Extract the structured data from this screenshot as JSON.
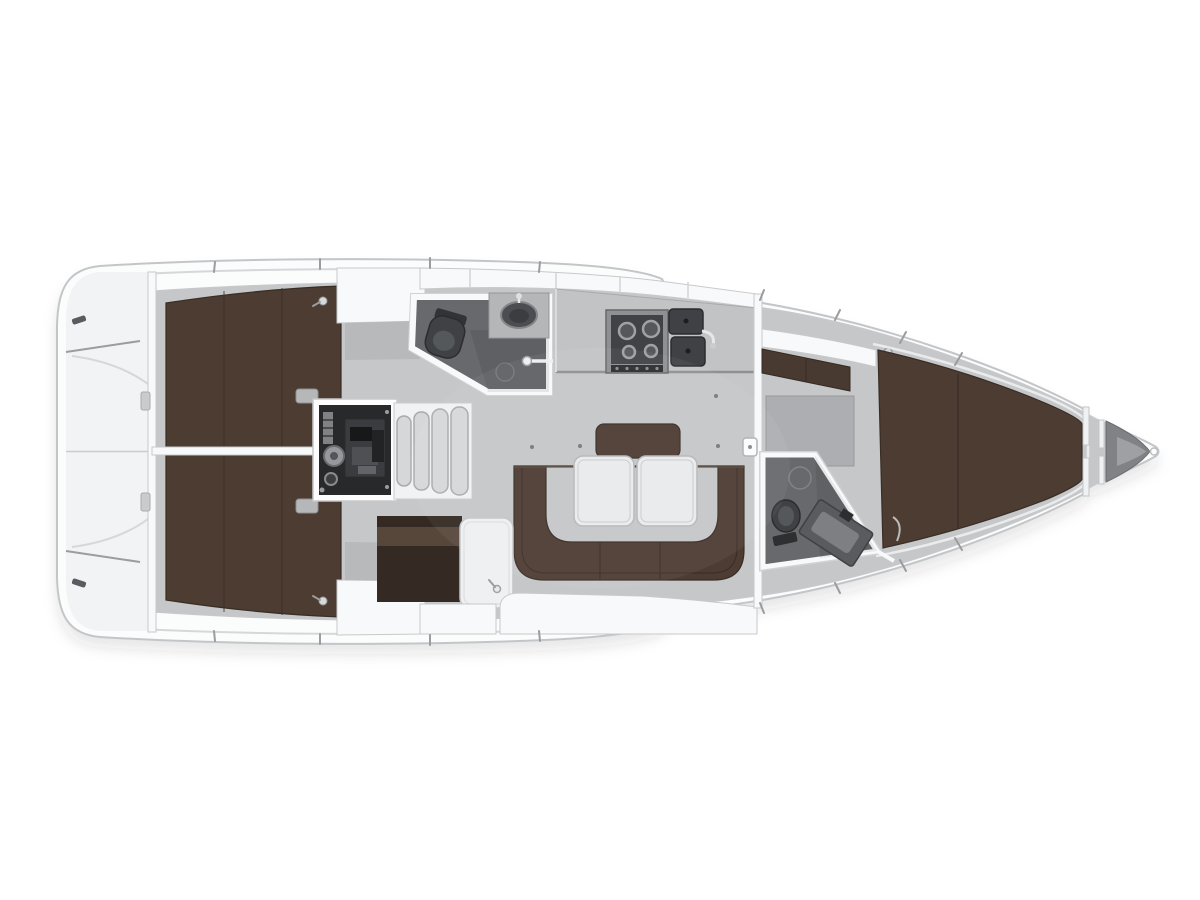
{
  "scene": {
    "kind": "sailing-yacht-interior-floor-plan",
    "view": "top-down",
    "orientation": "bow-right",
    "visible_text": ""
  },
  "palette": {
    "background": "#ffffff",
    "hull_white": "#fbfcfc",
    "hull_outline": "#c3c6c9",
    "hull_inner_line": "#d5d7d9",
    "deck_panel": "#f2f3f5",
    "wall_white": "#f8f9fa",
    "wall_edge": "#c7c9cb",
    "interior_floor": "#c6c7c9",
    "floor_mat": "#adaeb1",
    "shelf_gray": "#b8b9bb",
    "counter_gray": "#c2c3c5",
    "upholstery_brown": "#4c3c32",
    "upholstery_brown_dark": "#392d25",
    "upholstery_brown_light": "#5e4c3f",
    "upholstery_band": "#57463a",
    "nav_recess": "#342a23",
    "wet_floor": "#67696d",
    "fixture_dark": "#3f4144",
    "fixture_mid": "#55585b",
    "fixture_light": "#7d7f83",
    "porcelain": "#eff0f1",
    "engine_dark": "#28292b",
    "engine_metal": "#8e9093",
    "step_fill": "#d6d7d8",
    "step_edge": "#a8aaac",
    "table_white": "#e9eaeb",
    "table_edge": "#b5b7b9",
    "steel": "#9a9c9f",
    "metal_mid": "#808285",
    "shadow": "rgba(42,46,51,0.12)"
  },
  "rooms": [
    {
      "id": "stern-swim-platform",
      "features": [
        "transom-trim",
        "cleat",
        "cleat"
      ]
    },
    {
      "id": "aft-cabin-port",
      "features": [
        "double-berth",
        "locker",
        "shelf"
      ]
    },
    {
      "id": "aft-cabin-starboard",
      "features": [
        "double-berth",
        "locker",
        "shelf"
      ]
    },
    {
      "id": "engine-compartment",
      "features": [
        "engine-block",
        "pulley",
        "filter"
      ]
    },
    {
      "id": "companionway",
      "features": [
        "step",
        "step",
        "step",
        "step"
      ]
    },
    {
      "id": "aft-head",
      "features": [
        "toilet",
        "sink",
        "shower-mixer",
        "drain"
      ]
    },
    {
      "id": "galley",
      "features": [
        "stove",
        "double-sink",
        "faucet",
        "counter"
      ]
    },
    {
      "id": "salon",
      "features": [
        "u-shaped-sofa",
        "backrest",
        "folding-table",
        "folding-table"
      ]
    },
    {
      "id": "nav-station",
      "features": [
        "chart-table",
        "seat"
      ]
    },
    {
      "id": "forward-head",
      "features": [
        "toilet",
        "vanity-sink",
        "shower-ring"
      ]
    },
    {
      "id": "forward-cabin",
      "features": [
        "v-berth",
        "wardrobe",
        "shelf"
      ]
    },
    {
      "id": "bow",
      "features": [
        "anchor-locker",
        "bulkhead",
        "stem-fitting"
      ]
    }
  ]
}
